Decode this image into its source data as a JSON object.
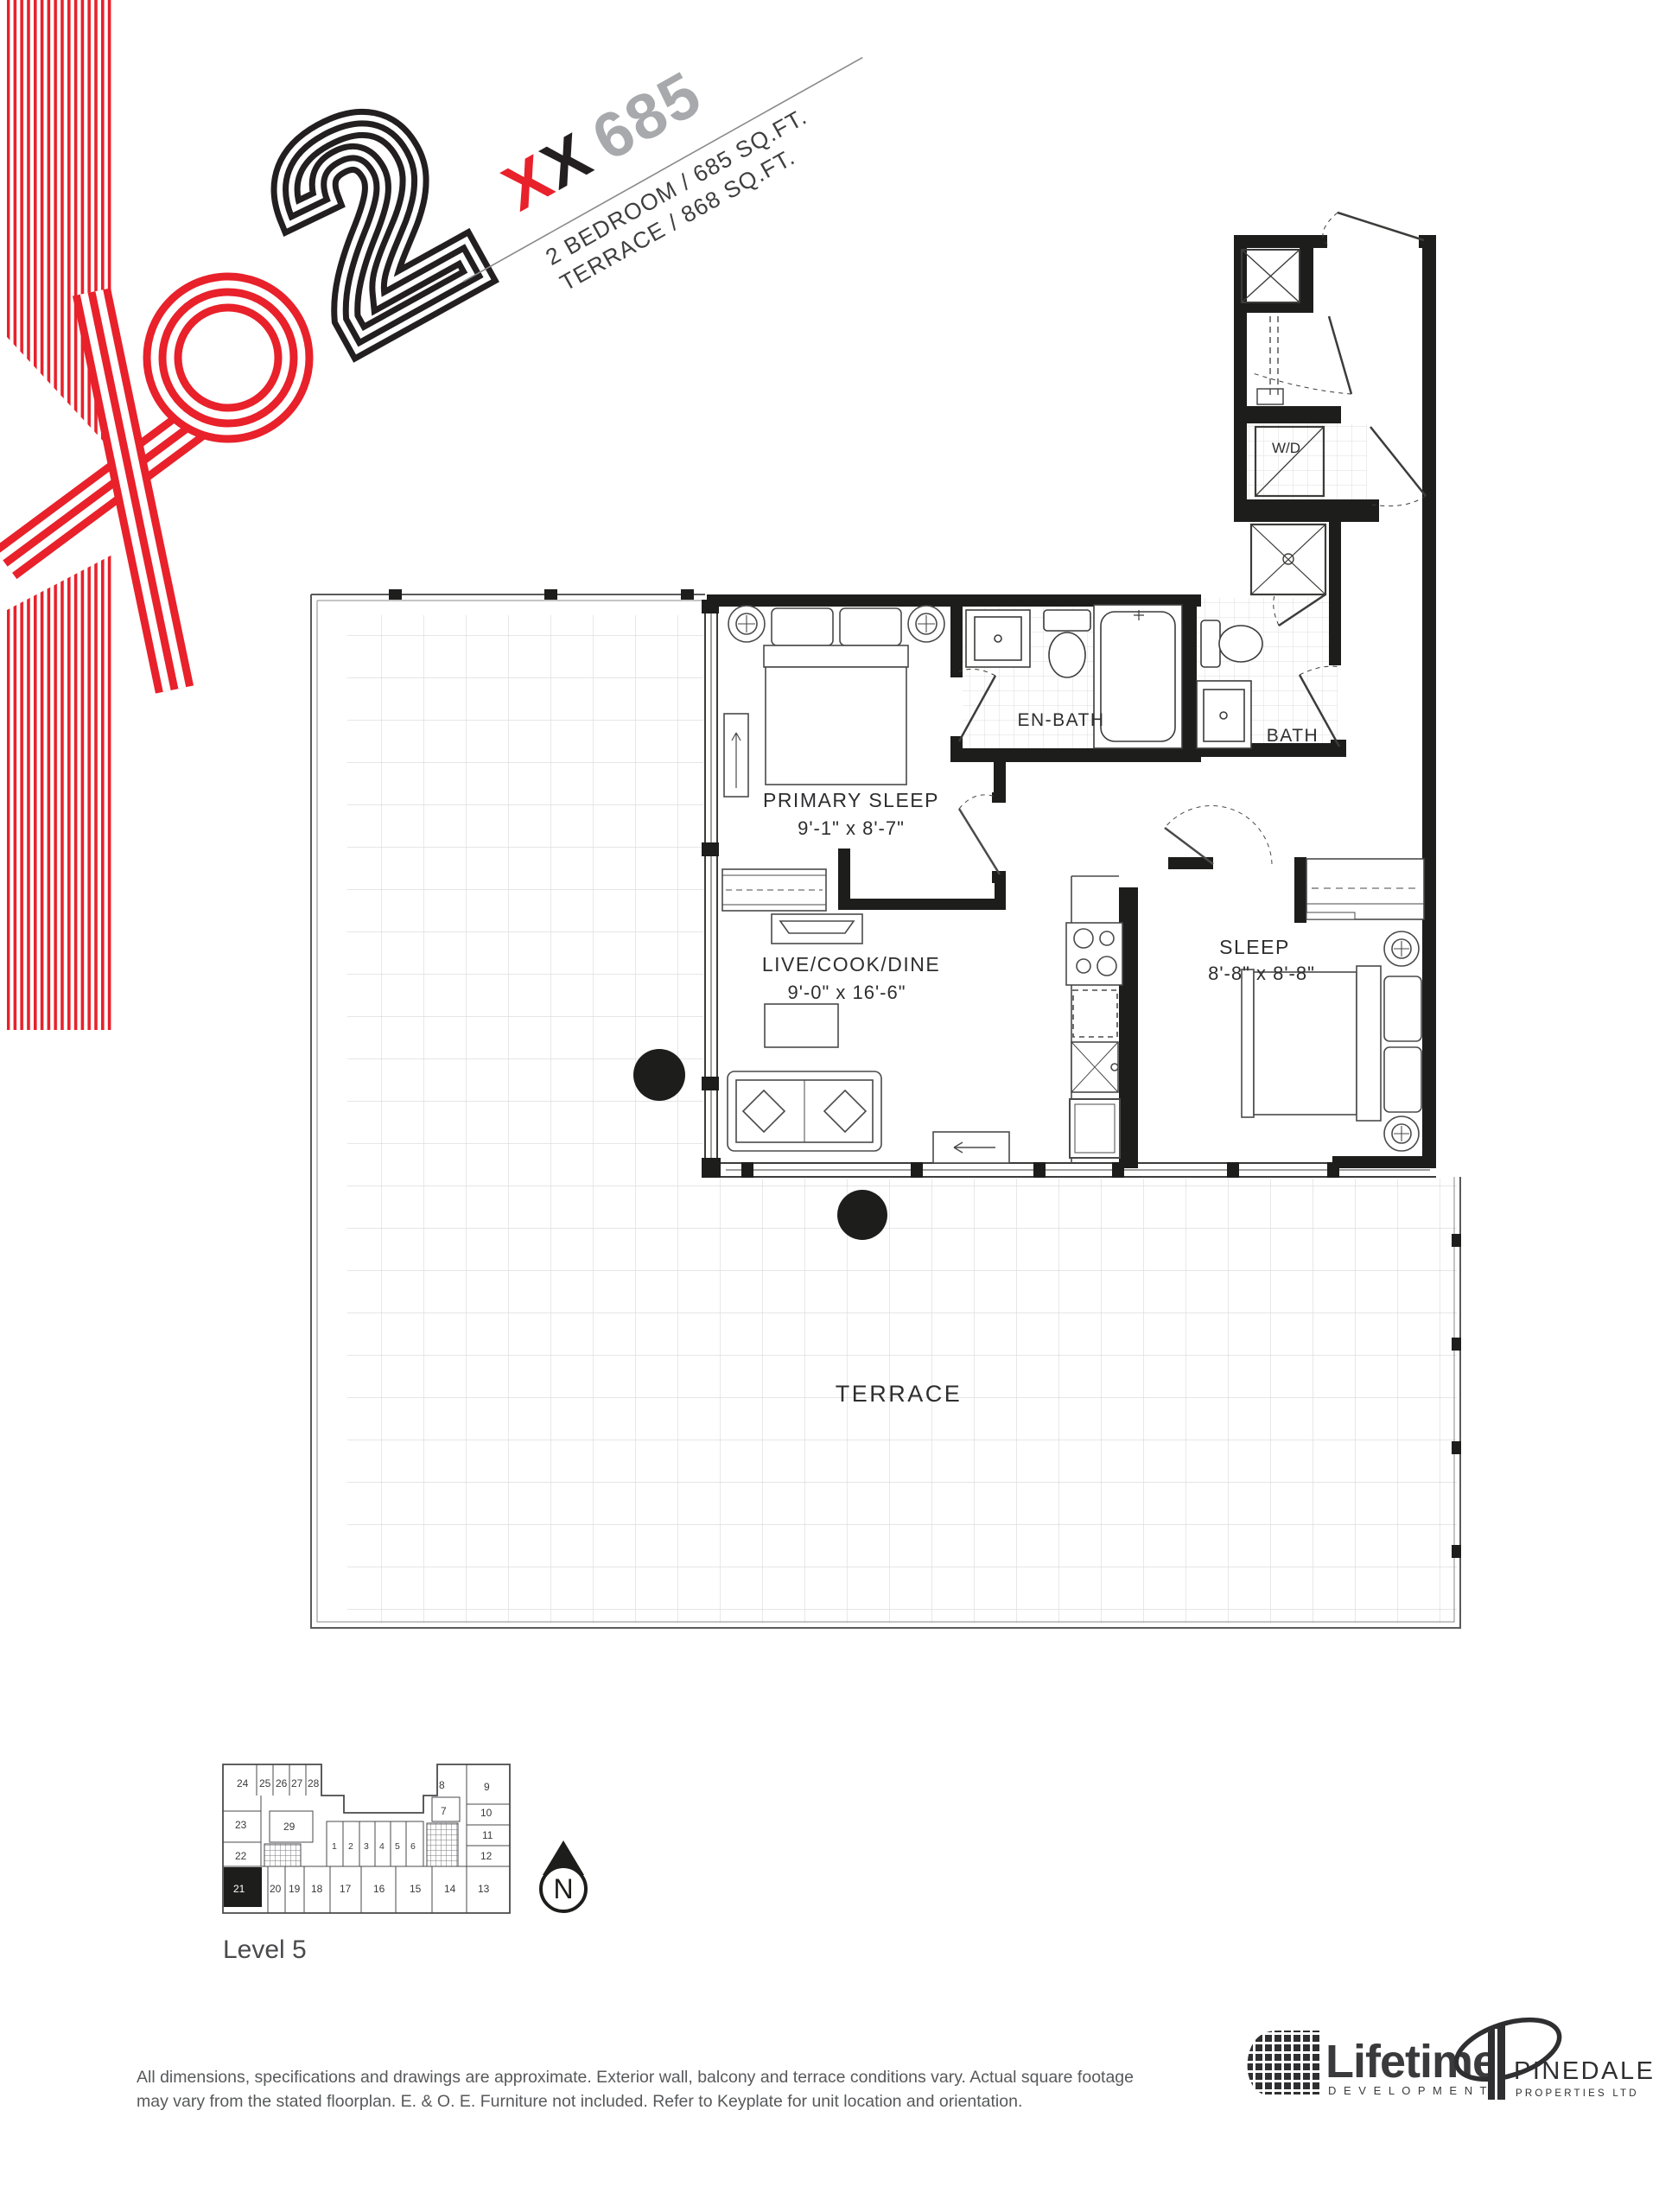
{
  "branding": {
    "project_logo": "XO2",
    "numeral": "2",
    "logo_red": "#e8212b",
    "logo_black": "#231f20"
  },
  "title": {
    "unit_code_x1": "X",
    "unit_code_x2": "X",
    "unit_number": "685",
    "number_color": "#a7a9ac",
    "spec_line1": "2 BEDROOM / 685 SQ.FT.",
    "spec_line2": "TERRACE / 868 SQ.FT."
  },
  "plan": {
    "rooms": [
      {
        "name": "PRIMARY SLEEP",
        "dimensions": "9'-1\" x 8'-7\""
      },
      {
        "name": "EN-BATH"
      },
      {
        "name": "BATH"
      },
      {
        "name": "W/D"
      },
      {
        "name": "SLEEP",
        "dimensions": "8'-8\" x 8'-8\""
      },
      {
        "name": "LIVE/COOK/DINE",
        "dimensions": "9'-0\" x 16'-6\""
      },
      {
        "name": "TERRACE"
      }
    ]
  },
  "keyplate": {
    "level_label": "Level 5",
    "highlighted_unit": "21",
    "north_label": "N",
    "unit_labels": [
      "1",
      "2",
      "3",
      "4",
      "5",
      "6",
      "7",
      "8",
      "9",
      "10",
      "11",
      "12",
      "13",
      "14",
      "15",
      "16",
      "17",
      "18",
      "19",
      "20",
      "21",
      "22",
      "23",
      "24",
      "25",
      "26",
      "27",
      "28",
      "29"
    ]
  },
  "disclaimer": {
    "line1": "All dimensions, specifications and drawings are approximate. Exterior wall, balcony and terrace conditions vary. Actual square footage",
    "line2": "may vary from the stated floorplan. E. & O. E. Furniture not included. Refer to Keyplate for unit location and orientation."
  },
  "footer_logos": {
    "lifetime_name": "Lifetime",
    "lifetime_sub": "D E V E L O P M E N T S",
    "pinedale_name": "PINEDALE",
    "pinedale_sub": "PROPERTIES LTD"
  }
}
